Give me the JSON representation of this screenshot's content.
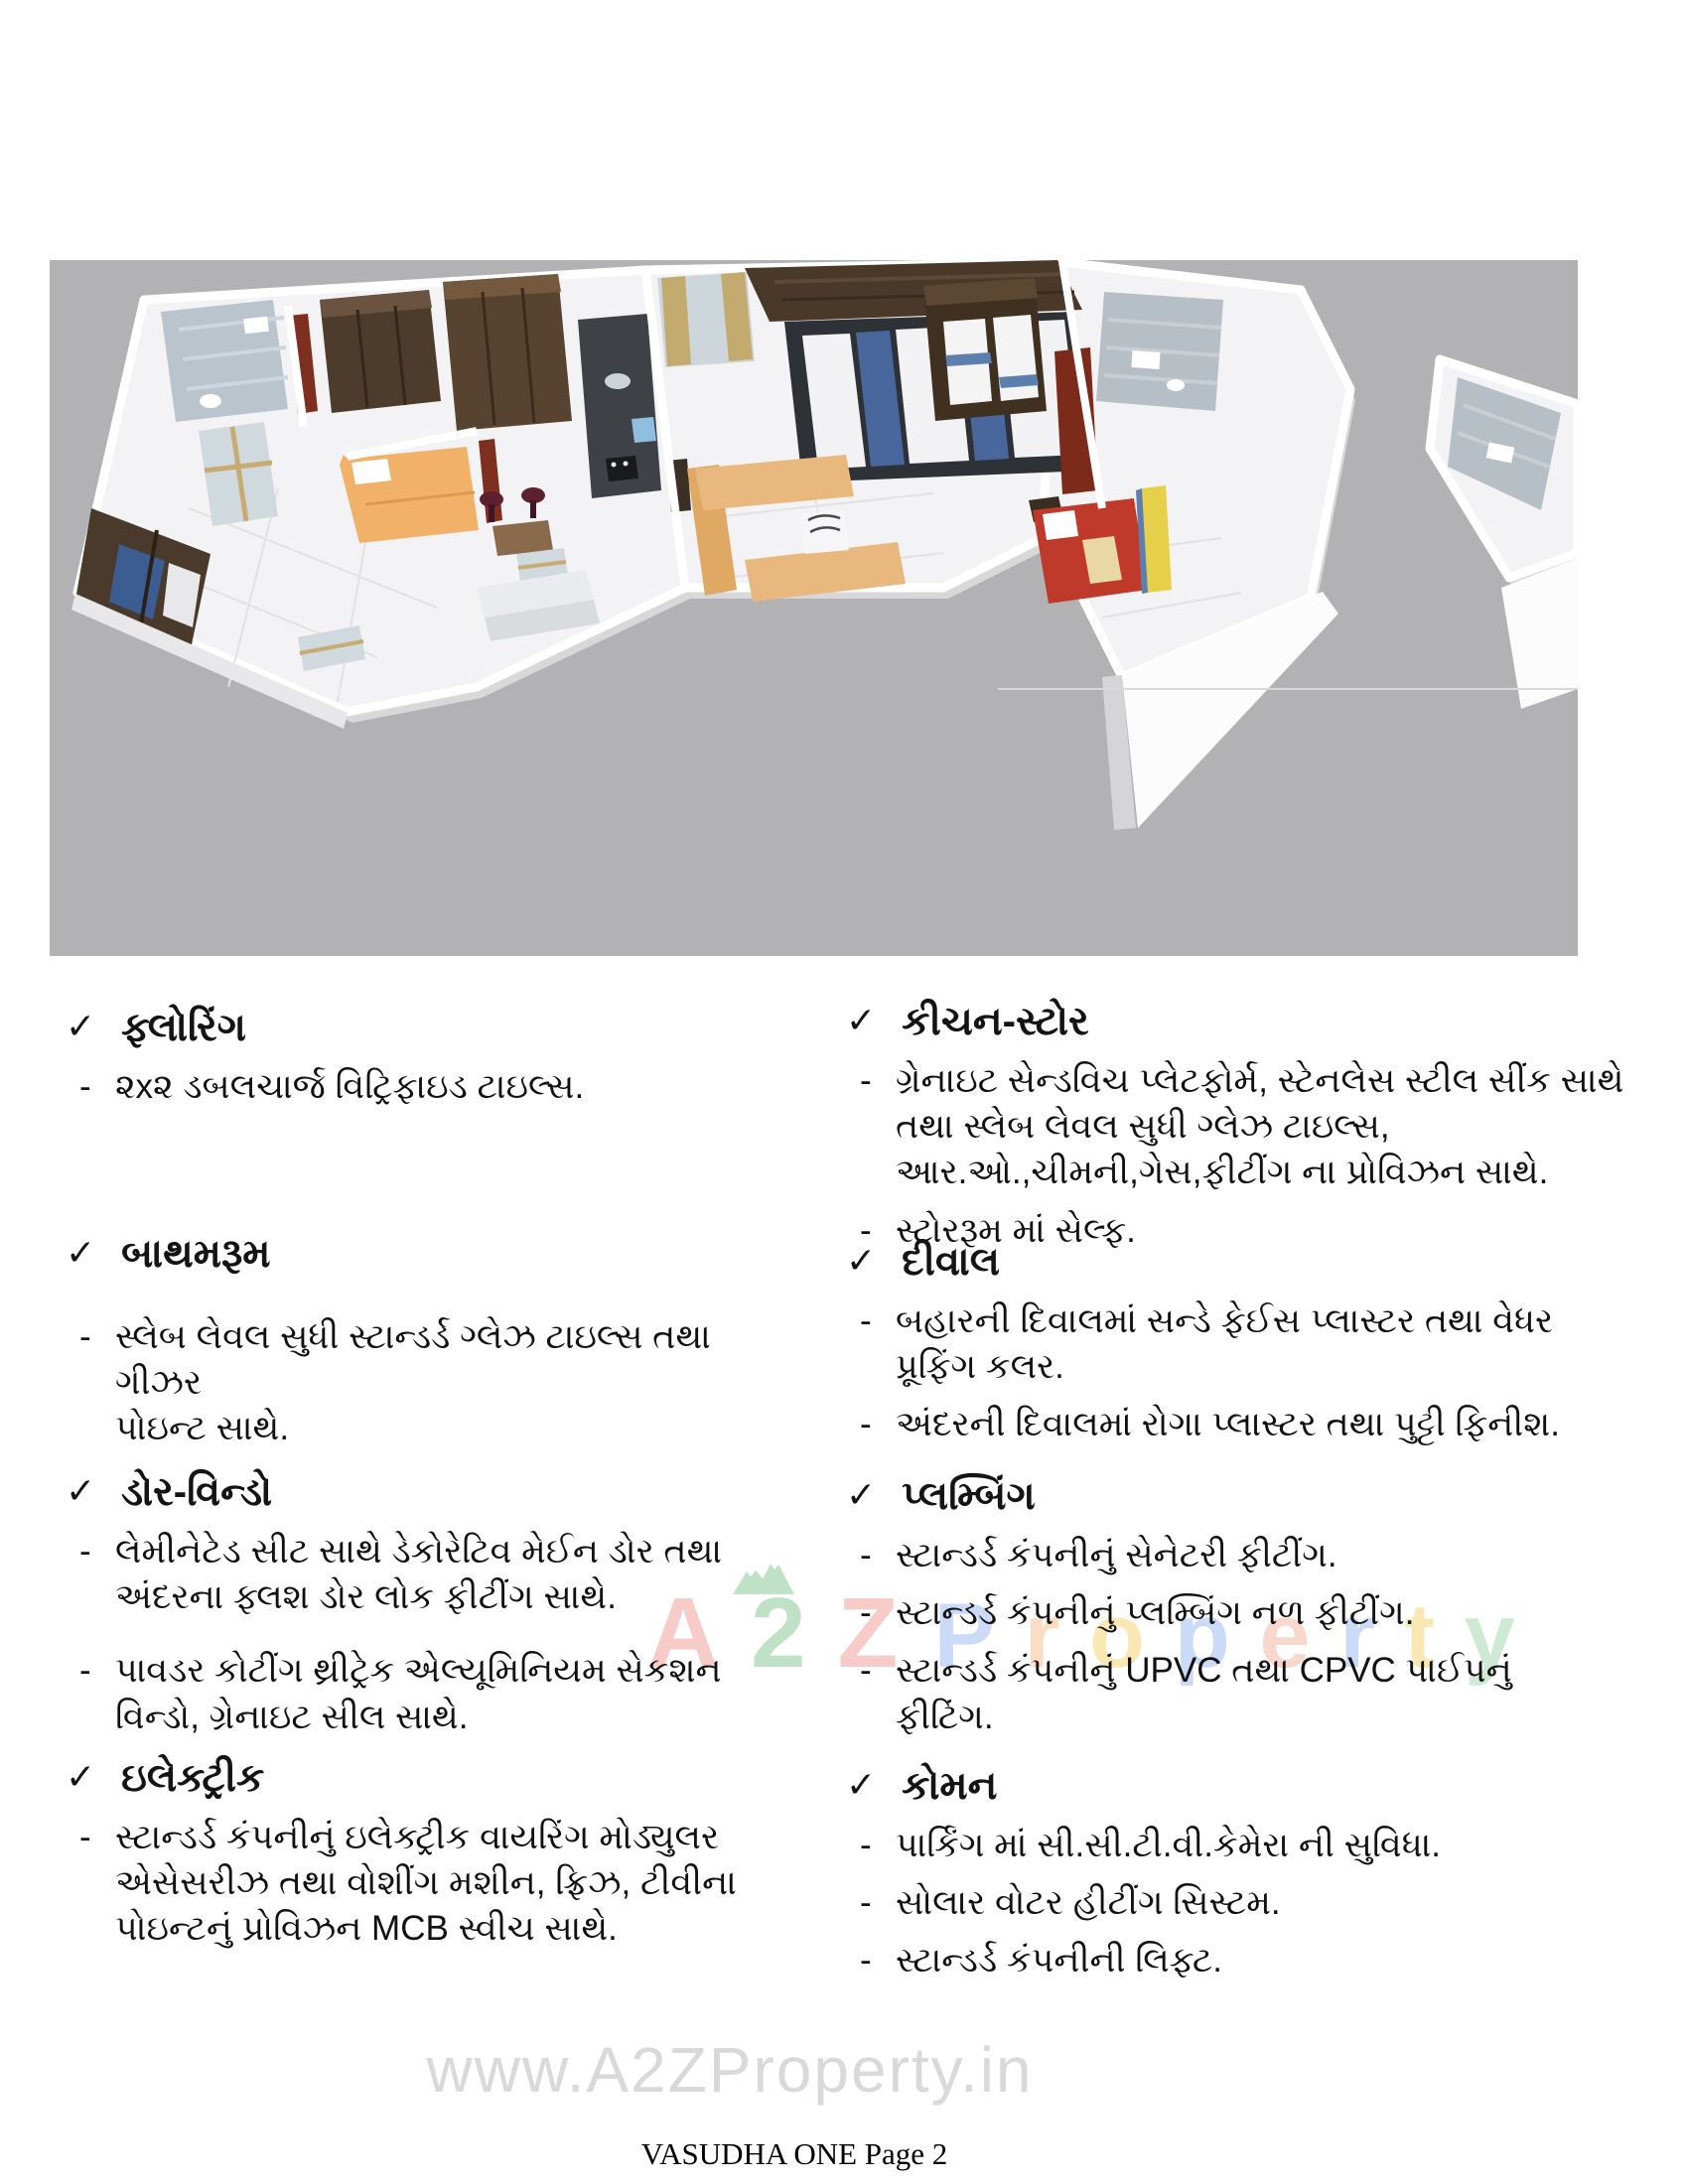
{
  "marks": {
    "check": "✓",
    "dash": "-"
  },
  "specs": {
    "left": [
      {
        "heading": "ફ્લોરિંગ",
        "items": [
          "૨x૨ ડબલચાર્જ  વિટ્રિફાઇડ ટાઇલ્સ."
        ]
      },
      {
        "heading": "બાથમરૂમ",
        "items": [
          "સ્લેબ લેવલ સુધી સ્ટાન્ડર્ડ ગ્લેઝ ટાઇલ્સ તથા ગીઝર\nપોઇન્ટ સાથે."
        ]
      },
      {
        "heading": "ડોર-વિન્ડો",
        "items": [
          "લેમીનેટેડ સીટ સાથે ડેકોરેટિવ મેઈન ડોર તથા\nઅંદરના ફ્લશ ડોર લોક ફીટીંગ સાથે.",
          "પાવડર કોટીંગ થ્રીટ્રેક એલ્યૂમિનિયમ સેકશન\nવિન્ડો, ગ્રેનાઇટ સીલ સાથે."
        ]
      },
      {
        "heading": "ઇલેક્ટ્રીક",
        "items": [
          "સ્ટાન્ડર્ડ કંપનીનું ઇલેક્ટ્રીક વાયરિંગ મોડ્યુલર\nએસેસરીઝ તથા વોશીંગ મશીન, ફ્રિઝ, ટીવીના\nપોઇન્ટનું પ્રોવિઝન MCB સ્વીચ સાથે."
        ]
      }
    ],
    "right": [
      {
        "heading": "કીચન-સ્ટોર",
        "items": [
          "ગ્રેનાઇટ સેન્ડવિચ પ્લેટફોર્મ, સ્ટેનલેસ સ્ટીલ સીંક સાથે\nતથા સ્લેબ લેવલ સુધી ગ્લેઝ ટાઇલ્સ,\nઆર.ઓ.,ચીમની,ગેસ,ફીટીંગ ના પ્રોવિઝન સાથે.",
          "સ્ટોરરૂમ માં સેલ્ફ."
        ]
      },
      {
        "heading": "દીવાલ",
        "items": [
          "બહારની દિવાલમાં સન્ડે ફેઈસ પ્લાસ્ટર તથા વેધર\nપ્રૂફિંગ કલર.",
          "અંદરની દિવાલમાં રોગા પ્લાસ્ટર તથા પુટ્ટી ફિનીશ."
        ]
      },
      {
        "heading": "પ્લમ્બિંગ",
        "items": [
          "સ્ટાન્ડર્ડ કંપનીનું સેનેટરી  ફીટીંગ.",
          "સ્ટાન્ડર્ડ કંપનીનું પ્લમ્બિંગ નળ ફીટીંગ.",
          "સ્ટાન્ડર્ડ કંપનીનું UPVC તથા CPVC પાઈપનું\nફીટિંગ."
        ]
      },
      {
        "heading": "કોમન",
        "items": [
          "પાર્કિંગ માં સી.સી.ટી.વી.કેમેરા ની સુવિધા.",
          "સોલાર વોટર હીટીંગ સિસ્ટમ.",
          "સ્ટાન્ડર્ડ કંપનીની લિફ્ટ."
        ]
      }
    ]
  },
  "watermark_center": {
    "letters": [
      {
        "ch": "A",
        "color": "#f1a29b"
      },
      {
        "ch": "2",
        "color": "#8ccb9b"
      },
      {
        "ch": "Z",
        "color": "#f1a29b"
      },
      {
        "ch": "P",
        "color": "#9fbcf2"
      },
      {
        "ch": "r",
        "color": "#f6c291"
      },
      {
        "ch": "o",
        "color": "#f5d677"
      },
      {
        "ch": "p",
        "color": "#9fbcf2"
      },
      {
        "ch": "e",
        "color": "#f4b9a4"
      },
      {
        "ch": "r",
        "color": "#9fbcf2"
      },
      {
        "ch": "t",
        "color": "#f5d677"
      },
      {
        "ch": "y",
        "color": "#a9d9b2"
      }
    ]
  },
  "watermark_bottom": {
    "text": "www.A2ZProperty.in"
  },
  "footer": {
    "text": "VASUDHA ONE Page 2"
  },
  "floorplan_palette": {
    "canvas_gray": "#b2b2b4",
    "floor_white": "#f3f3f5",
    "wood_dark": "#4d3b2b",
    "sofa_tan": "#e9b87e",
    "bed_orange": "#f1b169",
    "bed_red": "#bf3a2b",
    "glass_blue": "#49679c",
    "tile_gray_blue": "#b9c4cd",
    "door_maroon": "#7e2f1f",
    "accent_yellow": "#e7d049"
  }
}
